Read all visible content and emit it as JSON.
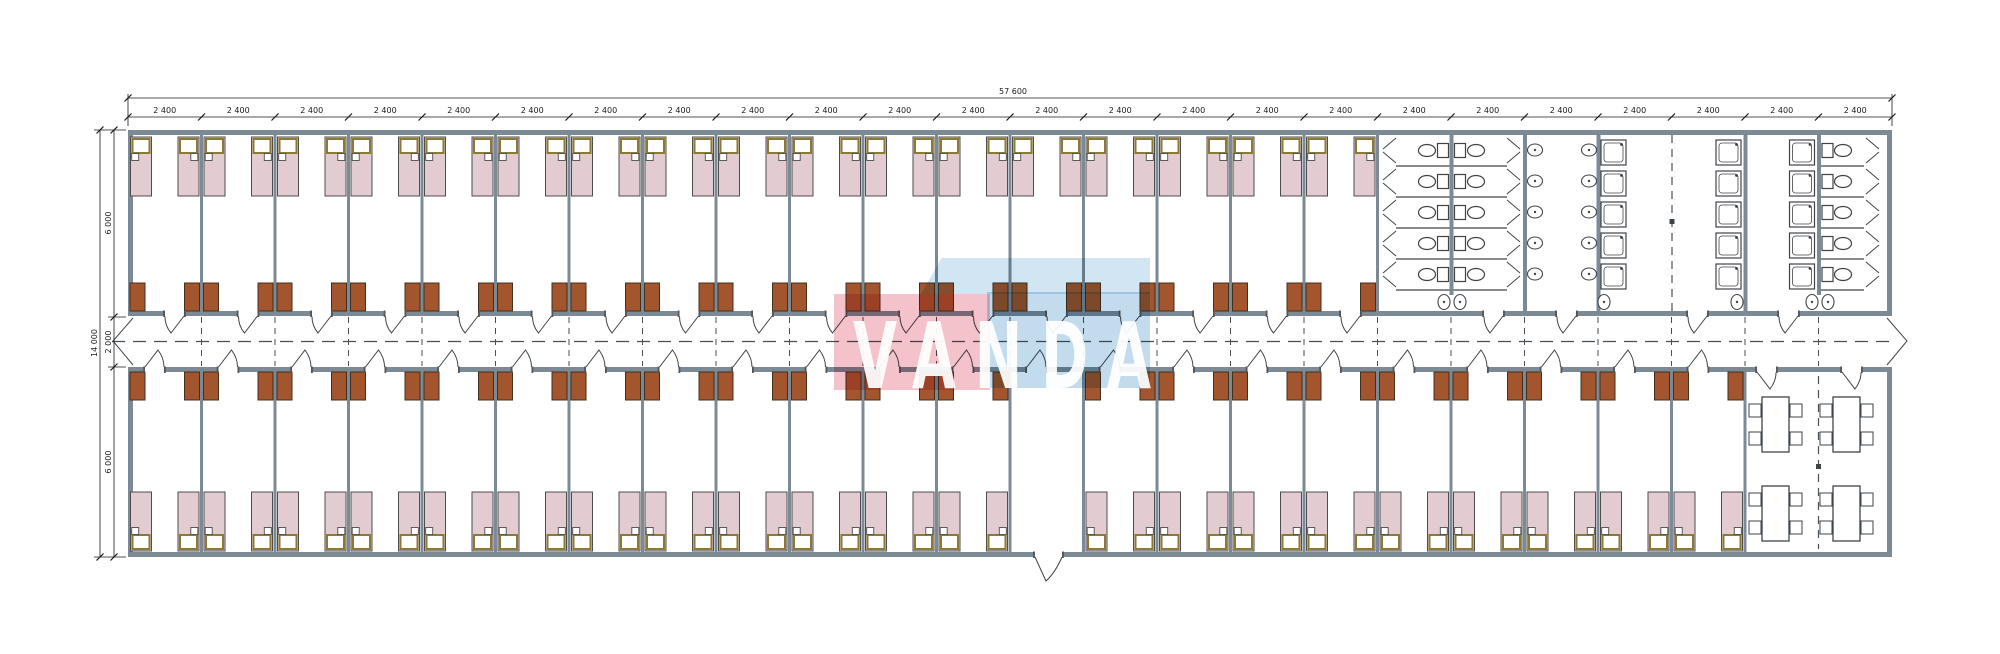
{
  "watermark": {
    "text": "VANDA"
  },
  "dims": {
    "total_width": "57 600",
    "module": "2 400",
    "module_count": 24,
    "total_height": "14 000",
    "room_depth_top": "6 000",
    "corridor_width": "2 000",
    "room_depth_bottom": "6 000"
  },
  "layout": {
    "top_bedroom_count": 17,
    "bottom_bedroom_count": 22,
    "entrance_module_index": 12,
    "beds_per_room": 2,
    "wardrobes_per_room": 2,
    "sanitary_rows": 5,
    "wc_toilet_count": 15,
    "washbasin_count": 16,
    "shower_count": 15,
    "dining_tables": 4,
    "chairs_per_table": 4
  },
  "colors": {
    "wall": "#7b8a94",
    "line": "#3f4448",
    "dash": "#4a4f53",
    "dim": "#1a1a1a",
    "bed_fill": "#e2ccd1",
    "bed_border": "#4d4d4d",
    "pillow_border": "#8a7a33",
    "wardrobe_fill": "#a3552e",
    "wardrobe_border": "#42301f",
    "fixture_stroke": "#3f4448",
    "watermark_pink": "#f3bcc4",
    "watermark_blue": "#bcd7eb",
    "watermark_blue_light": "#cde2f1",
    "watermark_text": "rgba(255,255,255,0.93)"
  }
}
